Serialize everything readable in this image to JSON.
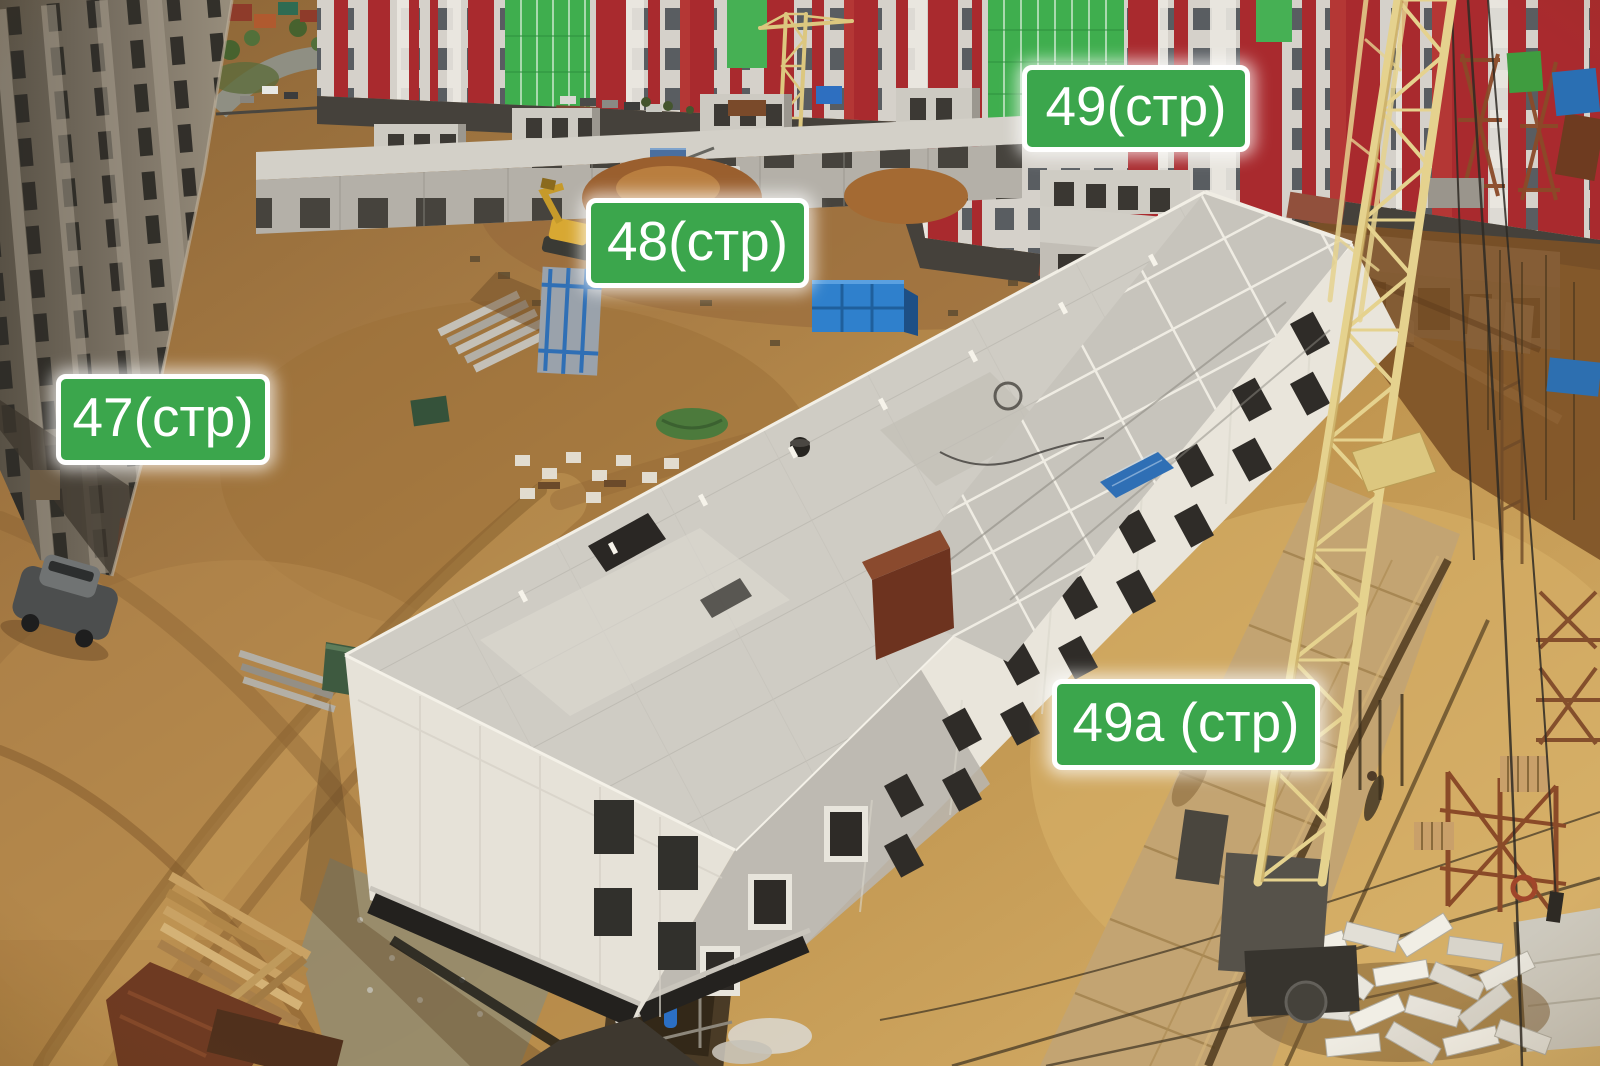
{
  "labels": [
    {
      "id": "47",
      "text": "47(стр)"
    },
    {
      "id": "48",
      "text": "48(стр)"
    },
    {
      "id": "49",
      "text": "49(стр)"
    },
    {
      "id": "49a",
      "text": "49а (стр)"
    }
  ],
  "colors": {
    "label_background": "#3BA64C",
    "label_border": "#FFFFFF",
    "label_text": "#FFFFFF",
    "apartment_red": "#A92A2E",
    "apartment_green_glass": "#3FAE4E",
    "crane_yellow": "#E5D28E",
    "container_blue": "#2F80CC",
    "concrete_light": "#E9E5DB",
    "concrete_roof": "#CFCCC4",
    "dirt_light": "#CFA763",
    "dirt_mid": "#B18349",
    "dirt_dark": "#7E5A31",
    "rust_brown": "#8A4A28"
  }
}
